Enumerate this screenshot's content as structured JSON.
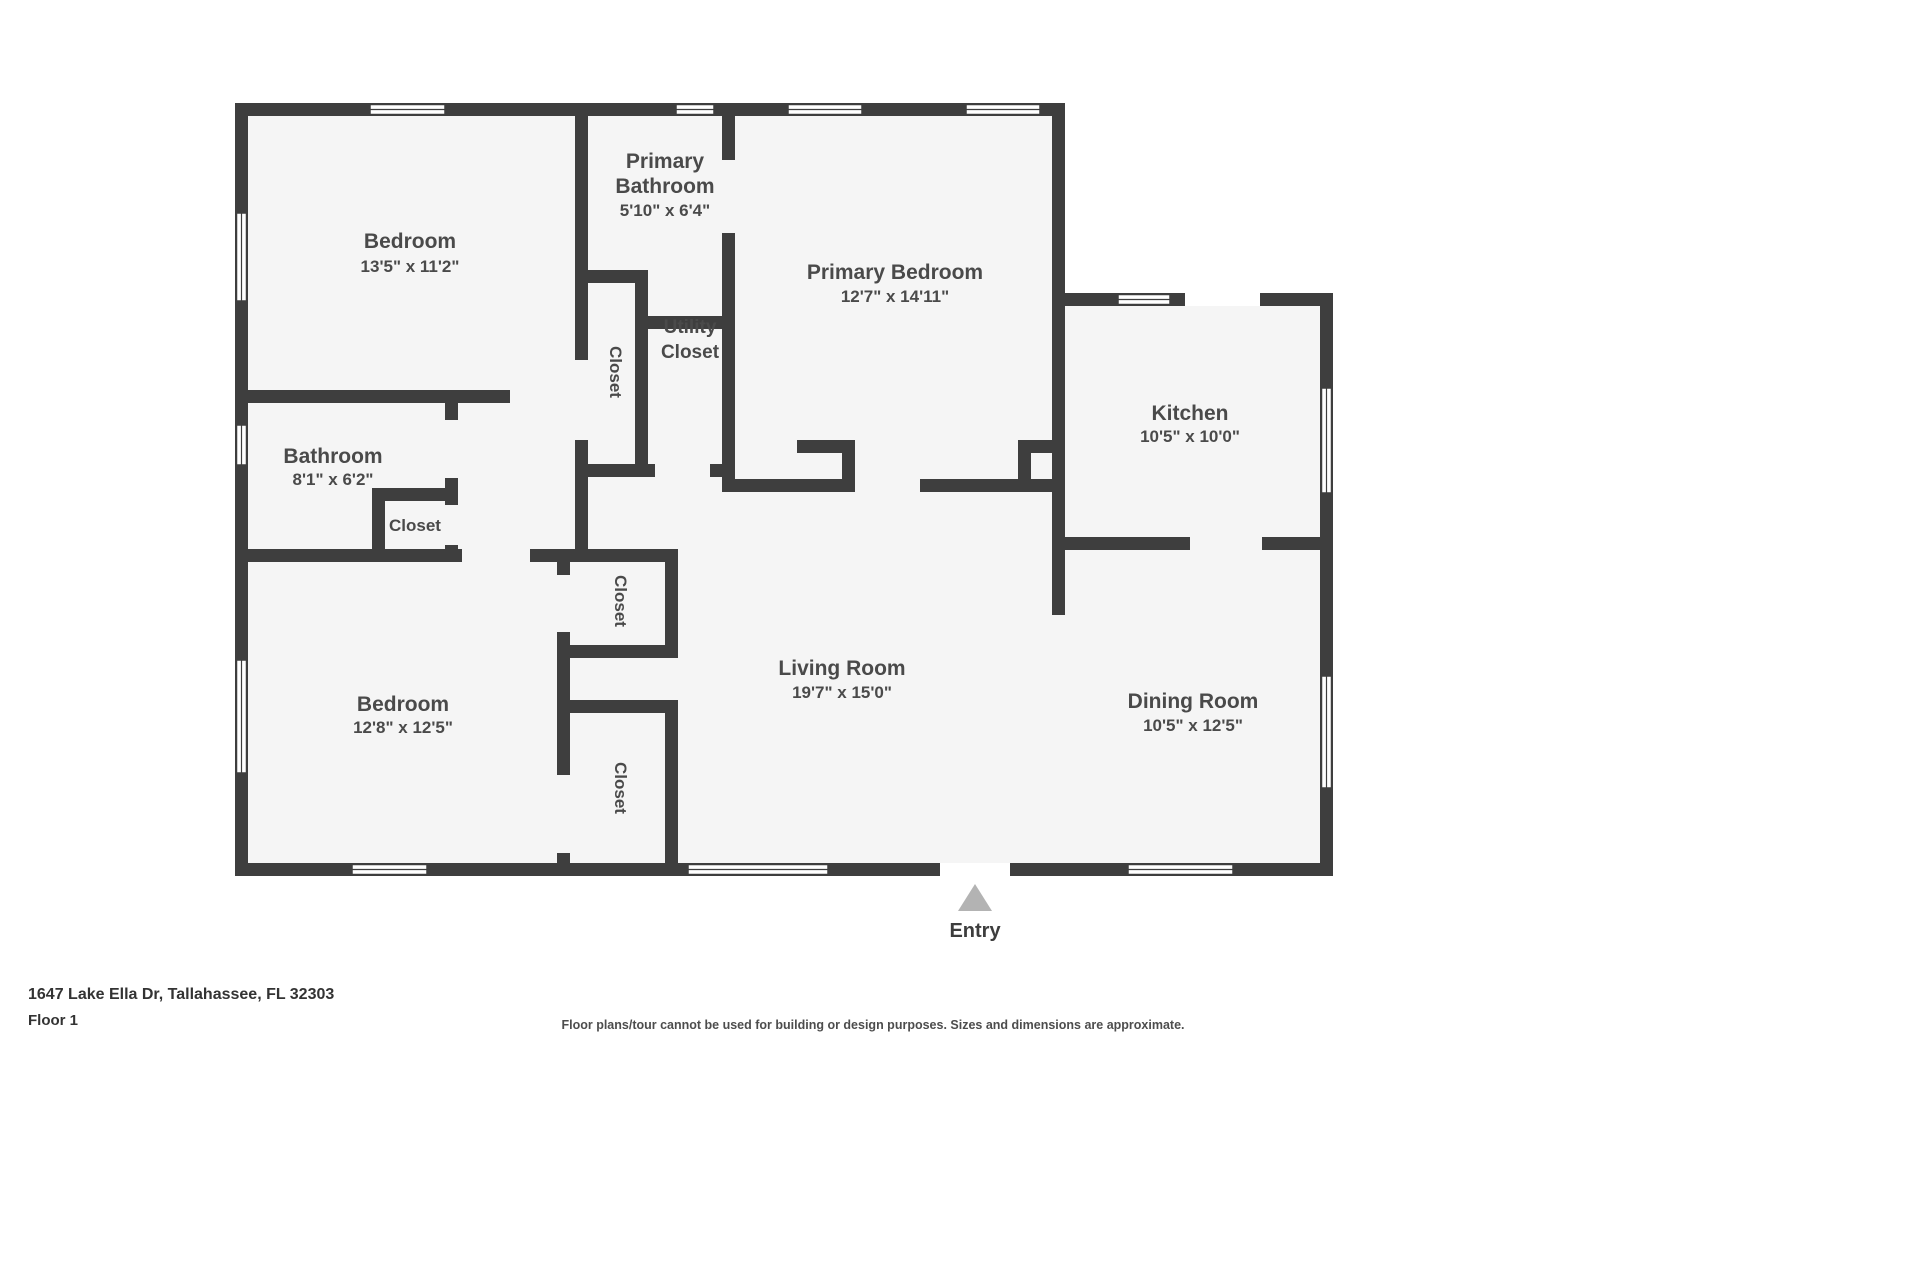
{
  "colors": {
    "wall": "#3e3e3e",
    "room_fill": "#f5f5f5",
    "text": "#4a4a4a",
    "entry_arrow": "#b3b3b3",
    "background": "#ffffff"
  },
  "floorplan": {
    "rooms": {
      "bedroom_top_left": {
        "name": "Bedroom",
        "dims": "13'5\" x 11'2\""
      },
      "primary_bathroom": {
        "line1": "Primary",
        "line2": "Bathroom",
        "dims": "5'10\" x 6'4\""
      },
      "primary_bedroom": {
        "name": "Primary Bedroom",
        "dims": "12'7\" x 14'11\""
      },
      "kitchen": {
        "name": "Kitchen",
        "dims": "10'5\" x 10'0\""
      },
      "bathroom": {
        "name": "Bathroom",
        "dims": "8'1\" x 6'2\""
      },
      "bedroom_bottom_left": {
        "name": "Bedroom",
        "dims": "12'8\" x 12'5\""
      },
      "living_room": {
        "name": "Living Room",
        "dims": "19'7\" x 15'0\""
      },
      "dining_room": {
        "name": "Dining Room",
        "dims": "10'5\" x 12'5\""
      },
      "utility_closet": {
        "line1": "Utility",
        "line2": "Closet"
      }
    },
    "closets": {
      "primary_closet": "Closet",
      "hall_closet": "Closet",
      "mid_closet_upper": "Closet",
      "mid_closet_lower": "Closet"
    },
    "entry_label": "Entry"
  },
  "footer": {
    "address": "1647 Lake Ella Dr, Tallahassee, FL 32303",
    "floor": "Floor 1",
    "disclaimer": "Floor plans/tour cannot be used for building or design purposes. Sizes and dimensions are approximate."
  }
}
